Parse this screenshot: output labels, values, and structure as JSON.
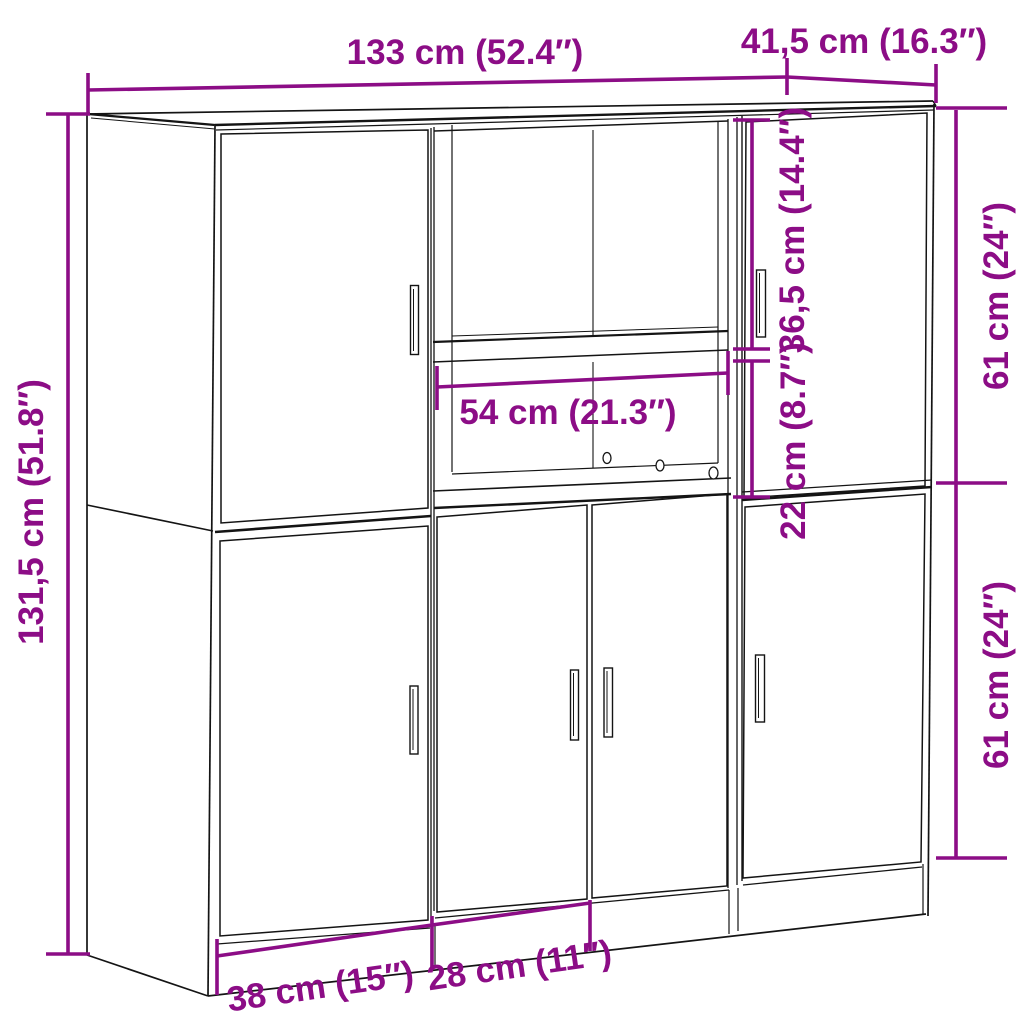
{
  "diagram": {
    "type": "furniture-dimension-diagram",
    "subject": "three-piece kitchen cabinet set line drawing with dimension callouts",
    "background_color": "#ffffff",
    "outline_color": "#141414",
    "dimension_color": "#8c0d86",
    "labels": {
      "total_width": "133 cm (52.4″)",
      "depth": "41,5 cm (16.3″)",
      "total_height": "131,5 cm (51.8″)",
      "niche_upper_height": "36,5 cm (14.4″)",
      "niche_lower_height": "22 cm (8.7″)",
      "upper_section_height": "61 cm (24″)",
      "lower_section_height": "61 cm (24″)",
      "niche_width": "54 cm (21.3″)",
      "left_door_width": "38 cm (15″)",
      "middle_door_width": "28 cm (11″)"
    }
  }
}
